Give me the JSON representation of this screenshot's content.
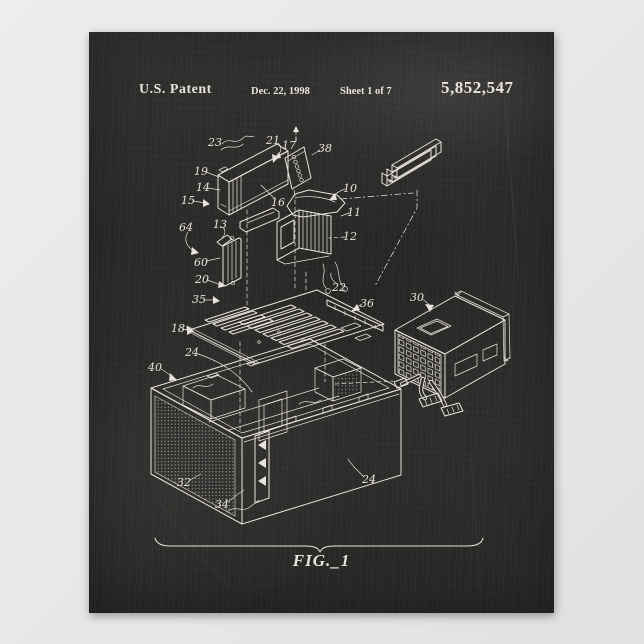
{
  "header": {
    "patent_label": "U.S. Patent",
    "date": "Dec. 22, 1998",
    "sheet": "Sheet 1 of 7",
    "patent_number": "5,852,547"
  },
  "figure": {
    "label": "FIG._1"
  },
  "ref_numerals": {
    "n10": "10",
    "n11": "11",
    "n12": "12",
    "n13": "13",
    "n14": "14",
    "n15": "15",
    "n16": "16",
    "n17": "17",
    "n18": "18",
    "n19": "19",
    "n20": "20",
    "n21": "21",
    "n22": "22",
    "n23": "23",
    "n24": "24",
    "n30": "30",
    "n32": "32",
    "n34": "34",
    "n35": "35",
    "n36": "36",
    "n38": "38",
    "n40": "40",
    "n60": "60",
    "n64": "64"
  },
  "colors": {
    "chalkboard": "#2f2d2b",
    "chalk": "#e7e4dc",
    "matte": "#eae8e6"
  }
}
